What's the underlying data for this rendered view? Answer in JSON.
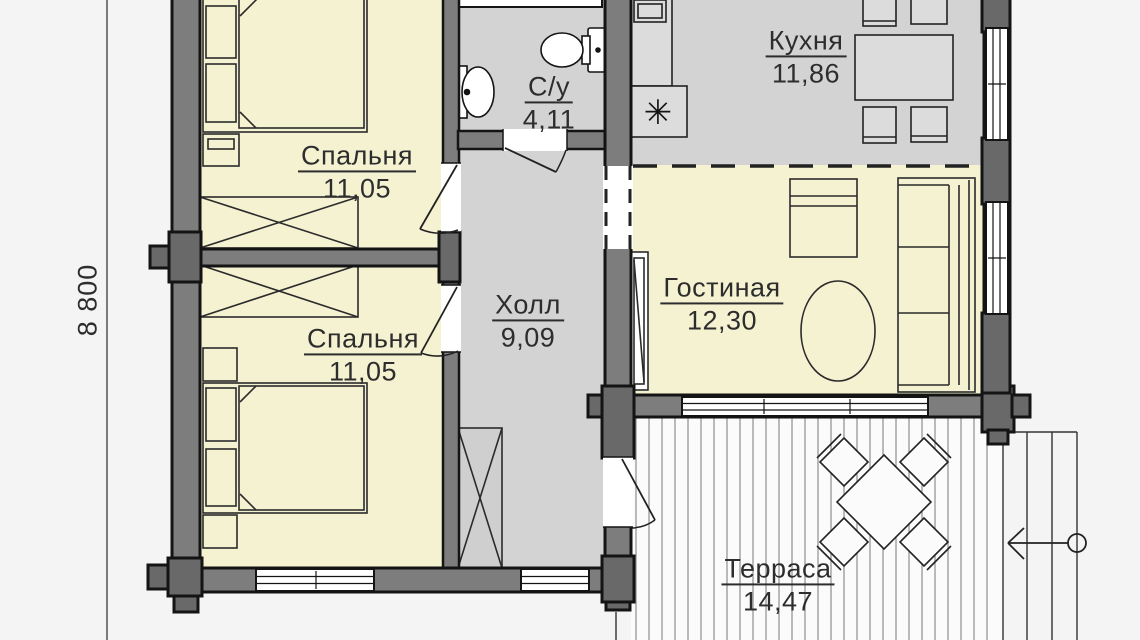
{
  "plan": {
    "dimension": {
      "left_total": "8 800"
    },
    "rooms": [
      {
        "id": "bedroom-top",
        "name": "Спальня",
        "area": "11,05"
      },
      {
        "id": "bathroom",
        "name": "С/у",
        "area": "4,11"
      },
      {
        "id": "kitchen",
        "name": "Кухня",
        "area": "11,86"
      },
      {
        "id": "hall",
        "name": "Холл",
        "area": "9,09"
      },
      {
        "id": "living-room",
        "name": "Гостиная",
        "area": "12,30"
      },
      {
        "id": "bedroom-bottom",
        "name": "Спальня",
        "area": "11,05"
      },
      {
        "id": "terrace",
        "name": "Терраса",
        "area": "14,47"
      }
    ],
    "symbols": {
      "stove": "✳"
    },
    "colors": {
      "living_zone_fill": "#f5f2d2",
      "service_zone_fill": "#d3d3d3",
      "wall_fill": "#7d7d7d",
      "corner_joint_fill": "#696969",
      "outline": "#141414",
      "background": "#f4f4f4"
    }
  }
}
